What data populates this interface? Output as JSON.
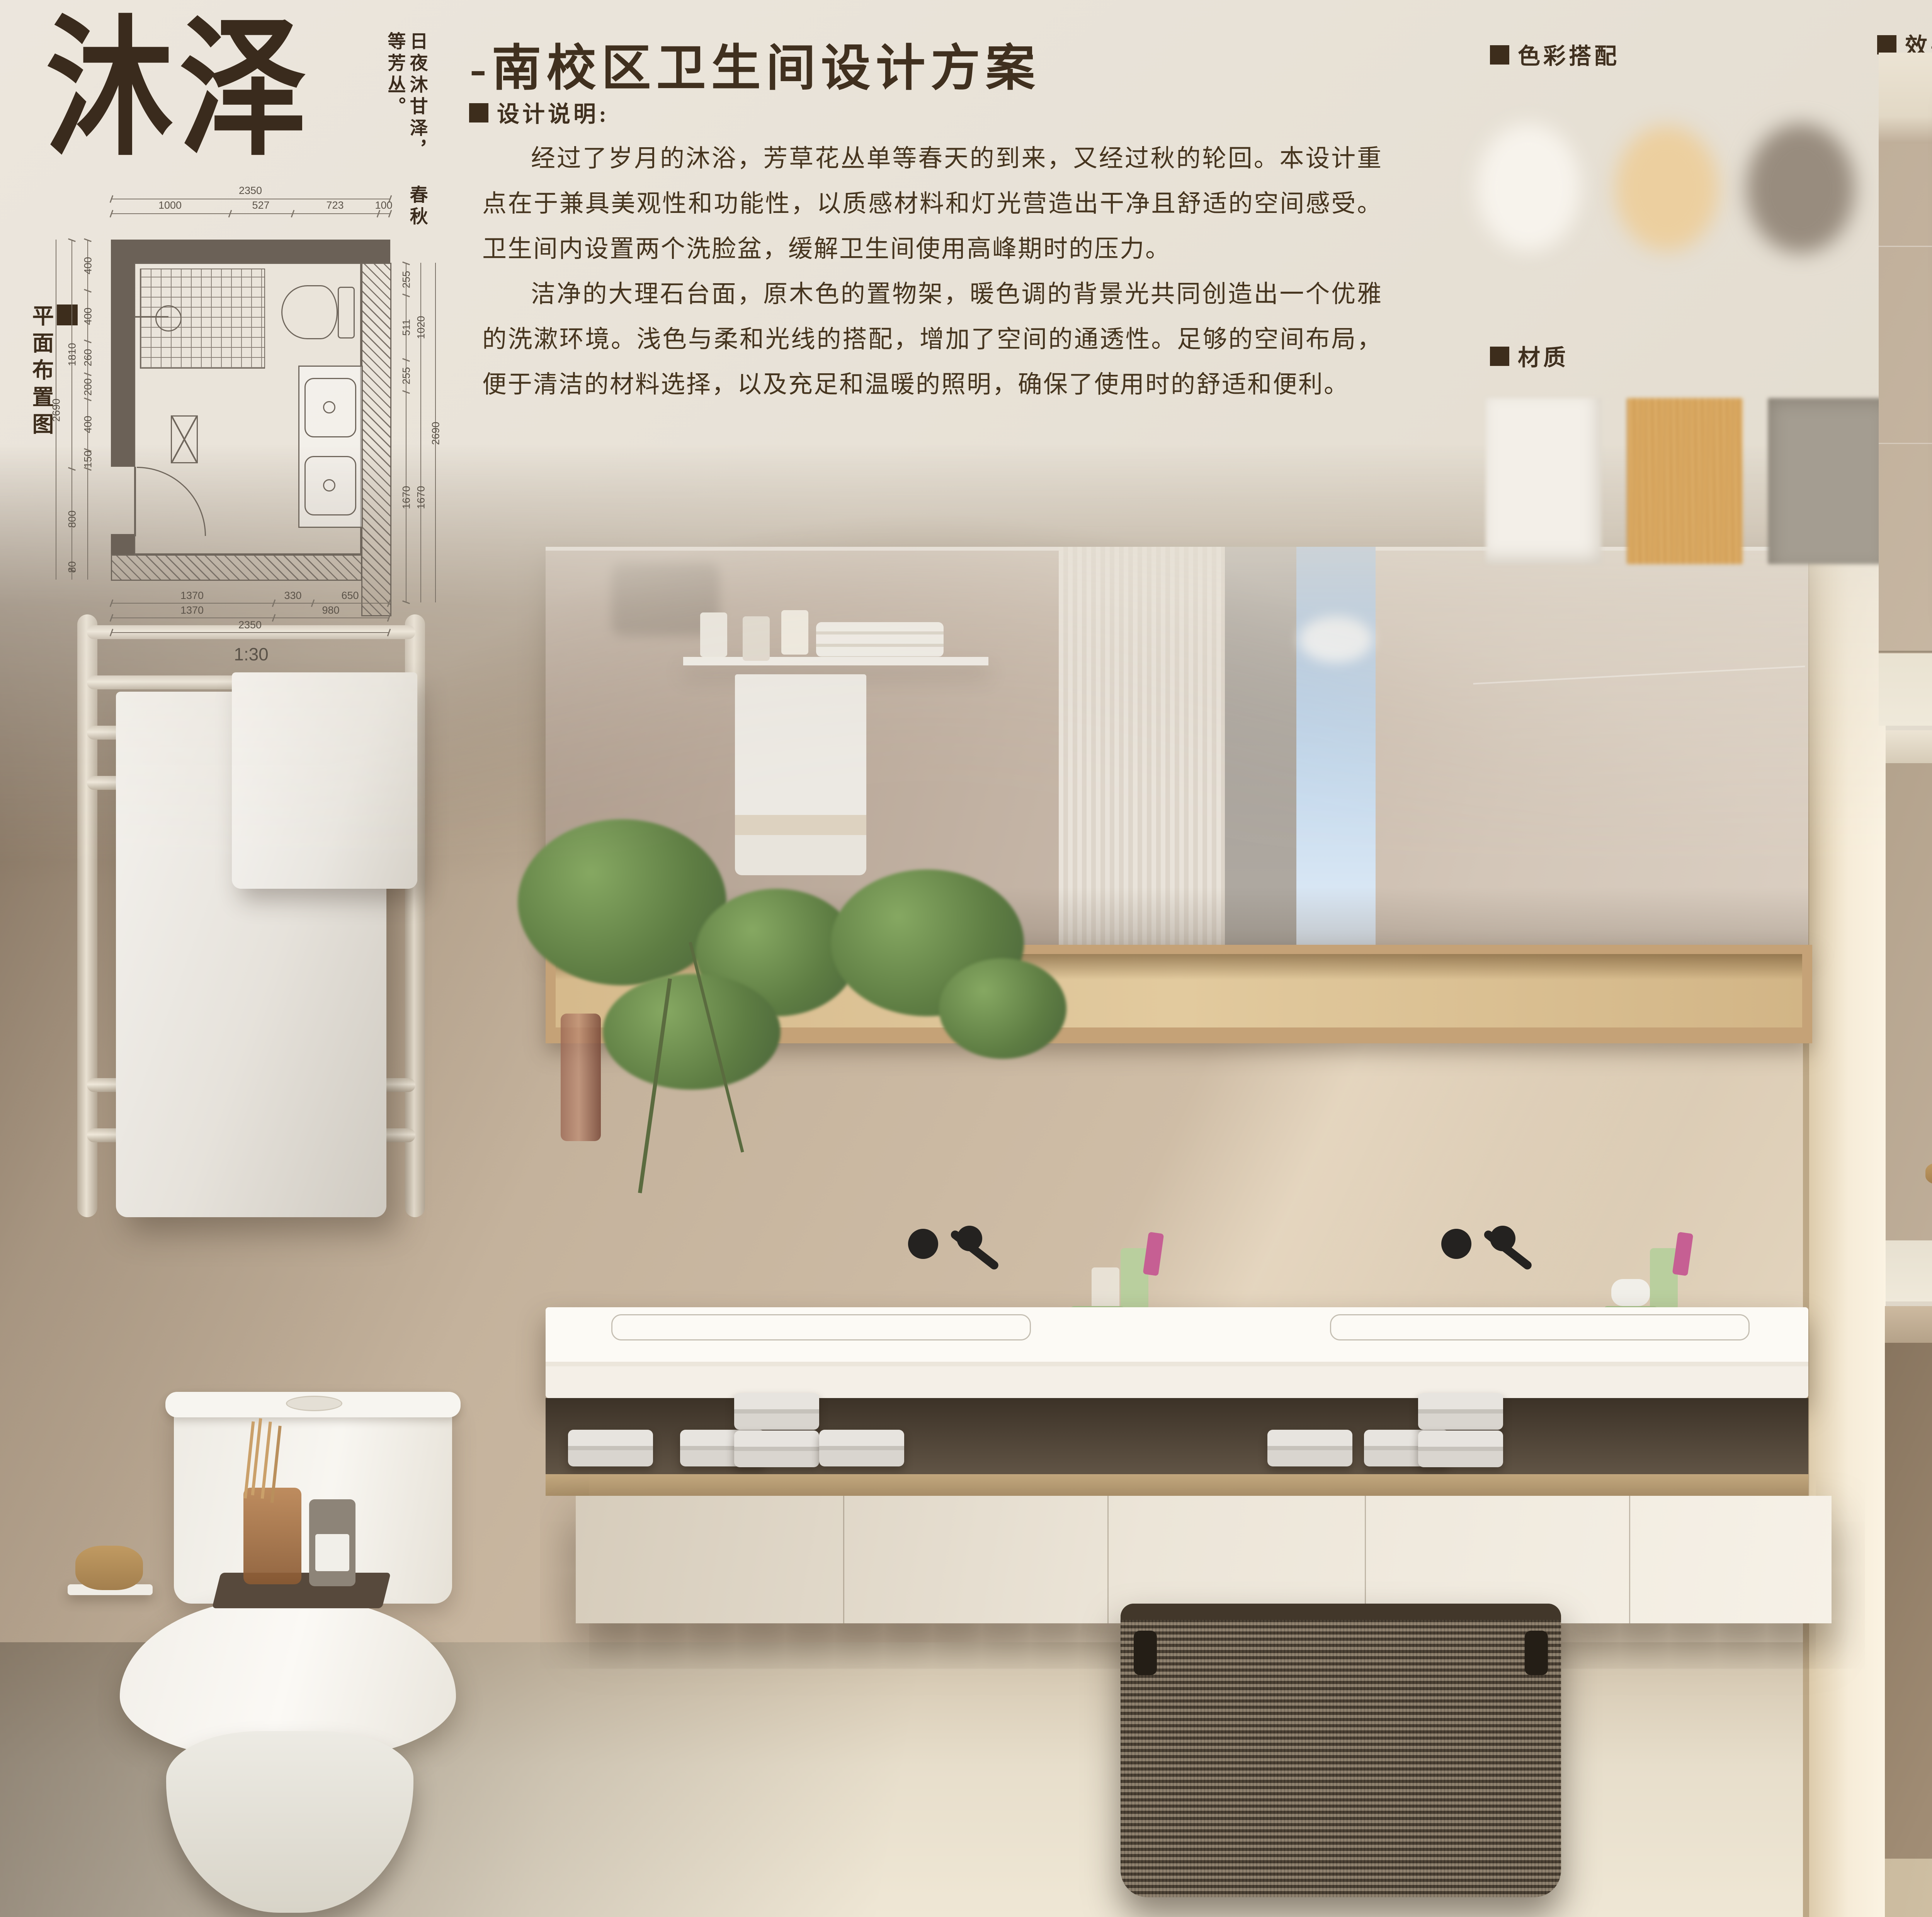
{
  "brand": {
    "logo": "沐泽",
    "slogan_right": "日夜沐甘泽，",
    "slogan_left": "春秋等芳丛。"
  },
  "header": {
    "title": "-南校区卫生间设计方案",
    "desc_heading": "设计说明:",
    "paragraphs": [
      "经过了岁月的沐浴，芳草花丛单等春天的到来，又经过秋的轮回。本设计重点在于兼具美观性和功能性，以质感材料和灯光营造出干净且舒适的空间感受。卫生间内设置两个洗脸盆，缓解卫生间使用高峰期时的压力。",
      "洁净的大理石台面，原木色的置物架，暖色调的背景光共同创造出一个优雅的洗漱环境。浅色与柔和光线的搭配，增加了空间的通透性。足够的空间布局，便于清洁的材料选择，以及充足和温暖的照明，确保了使用时的舒适和便利。"
    ]
  },
  "plan": {
    "label": "平面布置图",
    "scale": "1:30",
    "dims": {
      "top_outer": "2350",
      "top_inner": [
        "1000",
        "527",
        "723",
        "100"
      ],
      "left_outer": "2690",
      "left_mid": [
        "1810",
        "800",
        "80"
      ],
      "left_inner": [
        "400",
        "400",
        "260",
        "200",
        "400",
        "150"
      ],
      "right_inner": [
        "255",
        "511",
        "255",
        "1670"
      ],
      "right_mid": [
        "1020",
        "1670"
      ],
      "right_outer": "2690",
      "bottom_row1": [
        "1370",
        "330",
        "650"
      ],
      "bottom_row2": [
        "1370",
        "980"
      ],
      "bottom_row3": "2350"
    }
  },
  "palette": {
    "heading": "色彩搭配",
    "colors": [
      "#f7f3ec",
      "#eccf9f",
      "#988c7e"
    ]
  },
  "materials": {
    "heading": "材质",
    "colors": [
      "#f3efe8",
      "#ddab62",
      "#a49d91"
    ]
  },
  "renders": {
    "heading": "效果图"
  }
}
